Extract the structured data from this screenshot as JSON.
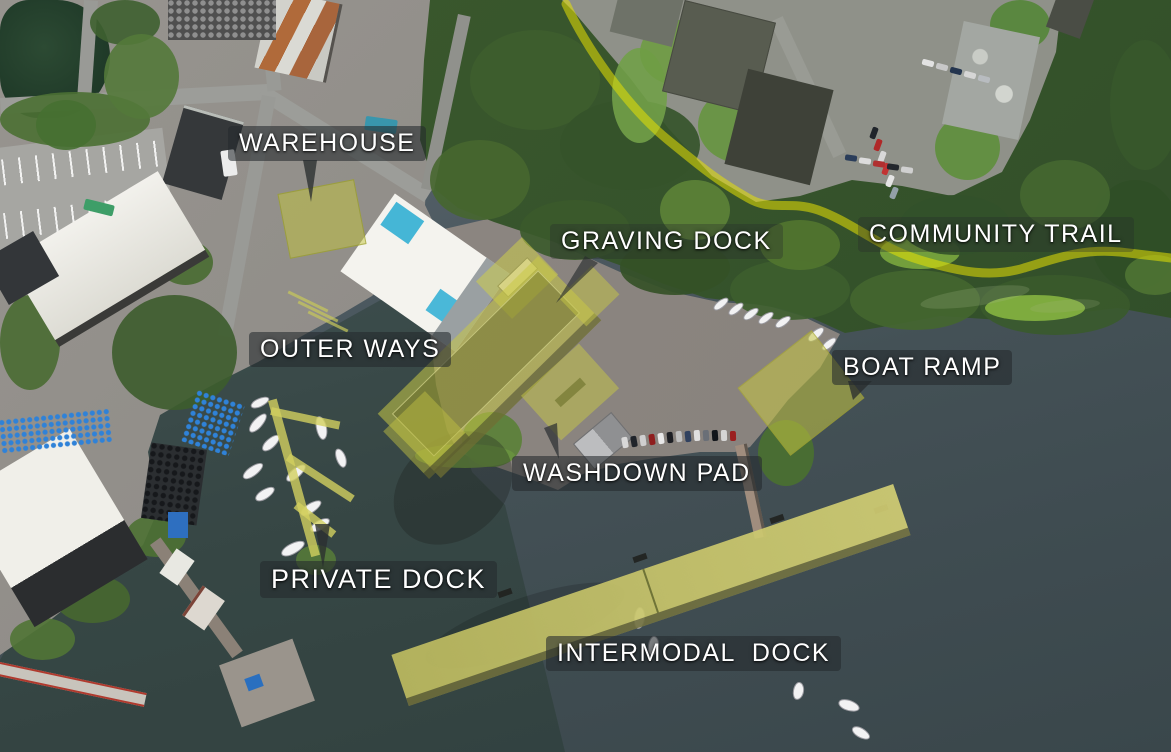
{
  "scene": {
    "description": "Annotated aerial photo of a marine industrial facility plan",
    "water_color_top": "#5c666c",
    "water_color_bottom": "#3a474b",
    "highlight_color": "#c8c64a",
    "trail_color": "#e8e104",
    "label_text_color": "#ffffff",
    "label_bg_color": "rgba(36,41,44,0.58)"
  },
  "labels": {
    "warehouse": "WAREHOUSE",
    "graving_dock": "GRAVING DOCK",
    "community_trail": "COMMUNITY TRAIL",
    "outer_ways": "OUTER WAYS",
    "boat_ramp": "BOAT RAMP",
    "washdown_pad": "WASHDOWN PAD",
    "private_dock": "PRIVATE DOCK",
    "intermodal_dock": "INTERMODAL  DOCK"
  }
}
